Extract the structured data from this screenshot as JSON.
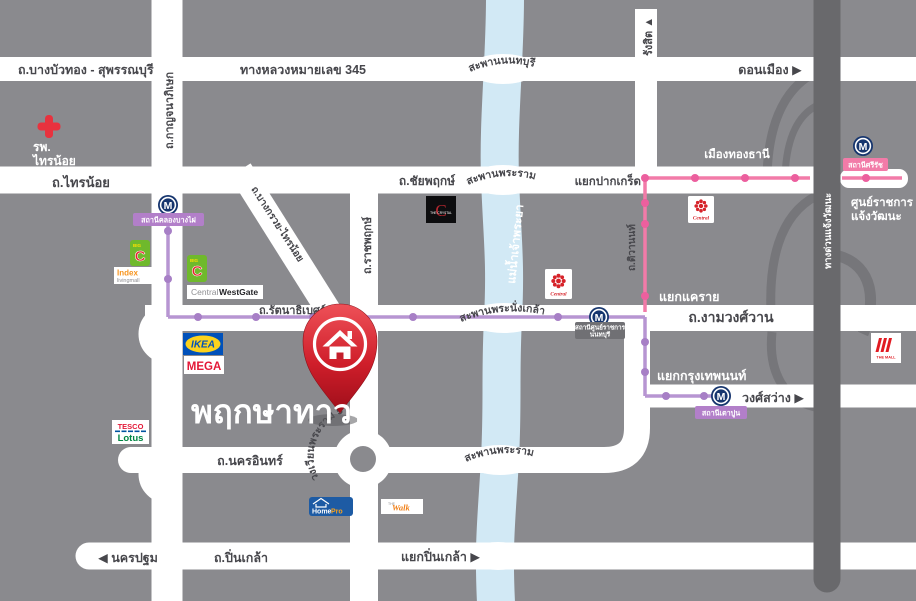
{
  "title": "พฤกษาทาวน์",
  "colors": {
    "background_gray": "#8a8a8e",
    "road_white": "#ffffff",
    "river_blue": "#d2e9f5",
    "expressway_gray": "#69696c",
    "mrt_pink_line": "#f27ba8",
    "mrt_purple_line": "#b795d2",
    "pin_red": "#c41f2b"
  },
  "roads": {
    "bang_bua_thong": "ถ.บางบัวทอง - สุพรรณบุรี",
    "highway345": "ทางหลวงหมายเลข 345",
    "don_mueang": "ดอนเมือง ▶",
    "sai_noi": "ถ.ไทรน้อย",
    "kanchanaphisek": "ถ.กาญจนาภิเษก",
    "rangsit": "รังสิต ▲",
    "chaiyaphruek": "ถ.ชัยพฤกษ์",
    "bang_kruai_sai_noi": "ถ.บางกรวย-ไทรน้อย",
    "ratchaphruek": "ถ.ราชพฤกษ์",
    "rattanathibet": "ถ.รัตนาธิเบศร์",
    "tiwanon": "ถ.ติวานนท์",
    "ngamwongwan": "ถ.งามวงศ์วาน",
    "nakhon_in": "ถ.นครอินทร์",
    "pinklao": "ถ.ปิ่นเกล้า",
    "nakhon_pathom": "◀ นครปฐม",
    "wong_sawang": "วงศ์สว่าง ▶",
    "expressway": "ทางด่วนแจ้งวัฒนะ"
  },
  "junctions": {
    "pak_kret": "แยกปากเกร็ด",
    "khae_rai": "แยกแคราย",
    "krungthep_non": "แยกกรุงเทพนนท์",
    "pinklao_jct": "แยกปิ่นเกล้า ▶",
    "rama5_circle": "วงเวียนพระราม 5"
  },
  "bridges": {
    "nonthaburi": "สะพานนนทบุรี",
    "rama4": "สะพานพระราม 4",
    "phra_nangklao": "สะพานพระนั่งเกล้า",
    "rama5": "สะพานพระราม 5"
  },
  "river": "แม่น้ำเจ้าพระยา",
  "places": {
    "hospital": {
      "line1": "รพ.",
      "line2": "ไทรน้อย"
    },
    "mueang_thong_thani": "เมืองทองธานี",
    "gov_complex": {
      "line1": "ศูนย์ราชการ",
      "line2": "แจ้งวัฒนะ"
    }
  },
  "mrt": {
    "m": "M",
    "khlong_bang_phai": "สถานีคลองบางไผ่",
    "si_rat": "สถานีศรีรัช",
    "gov_center": {
      "line1": "สถานีศูนย์ราชการ",
      "line2": "นนทบุรี"
    },
    "tao_poon": "สถานีเตาปูน"
  },
  "logos": {
    "big_c": {
      "big": "BIG",
      "c": "C"
    },
    "index": {
      "line1": "Index",
      "line2": "livingmall"
    },
    "central_westgate": {
      "part1": "Central",
      "part2": "WestGate"
    },
    "ikea": "IKEA",
    "mega": "MEGA",
    "tesco": {
      "line1": "TESCO",
      "line2": "Lotus"
    },
    "crystal": {
      "c": "C",
      "text": "THE CRYSTAL"
    },
    "central": "Central",
    "the_mall": "THE MALL",
    "homepro": {
      "part1": "Home",
      "part2": "Pro"
    },
    "the_walk": {
      "small": "THE",
      "script": "Walk"
    }
  }
}
